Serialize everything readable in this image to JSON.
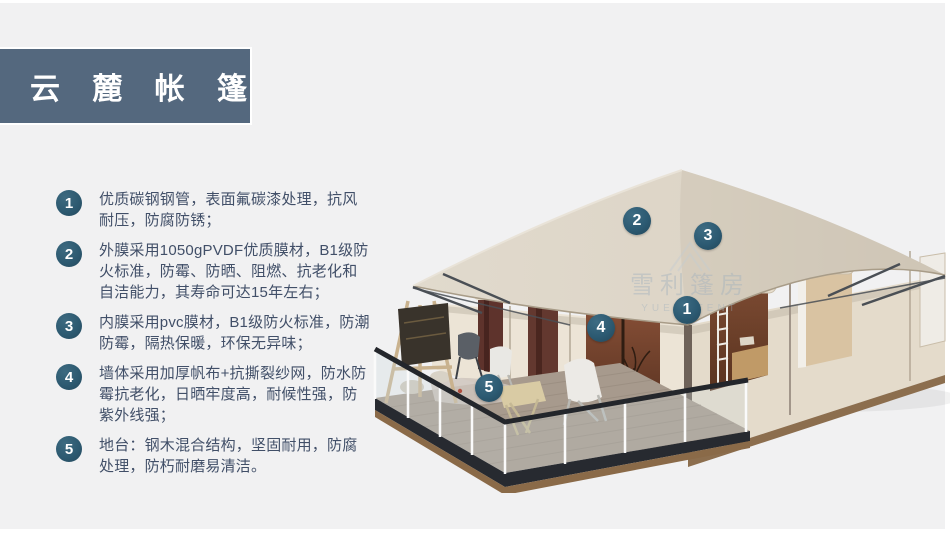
{
  "slide": {
    "title": "云  麓  帐  篷",
    "background_color": "#f1f1f2",
    "banner_color": "#54687e",
    "text_color": "#414f68",
    "badge_color": "#2d5a71",
    "callout_color": "#2c5a72"
  },
  "features": {
    "items": [
      {
        "num": "1",
        "text": "优质碳钢钢管，表面氟碳漆处理，抗风耐压，防腐防锈；"
      },
      {
        "num": "2",
        "text": "外膜采用1050gPVDF优质膜材，B1级防火标准，防霉、防晒、阻燃、抗老化和自洁能力，其寿命可达15年左右；"
      },
      {
        "num": "3",
        "text": "内膜采用pvc膜材，B1级防火标准，防潮防霉，隔热保暖，环保无异味；"
      },
      {
        "num": "4",
        "text": "墙体采用加厚帆布+抗撕裂纱网，防水防霉抗老化，日晒牢度高，耐候性强，防紫外线强；"
      },
      {
        "num": "5",
        "text": "地台：钢木混合结构，坚固耐用，防腐处理，防朽耐磨易清洁。"
      }
    ]
  },
  "tent": {
    "callouts": [
      {
        "label": "1"
      },
      {
        "label": "2"
      },
      {
        "label": "3"
      },
      {
        "label": "4"
      },
      {
        "label": "5"
      }
    ],
    "watermark": {
      "cn": "雪利篷房",
      "en": "YUELI TENT"
    }
  }
}
